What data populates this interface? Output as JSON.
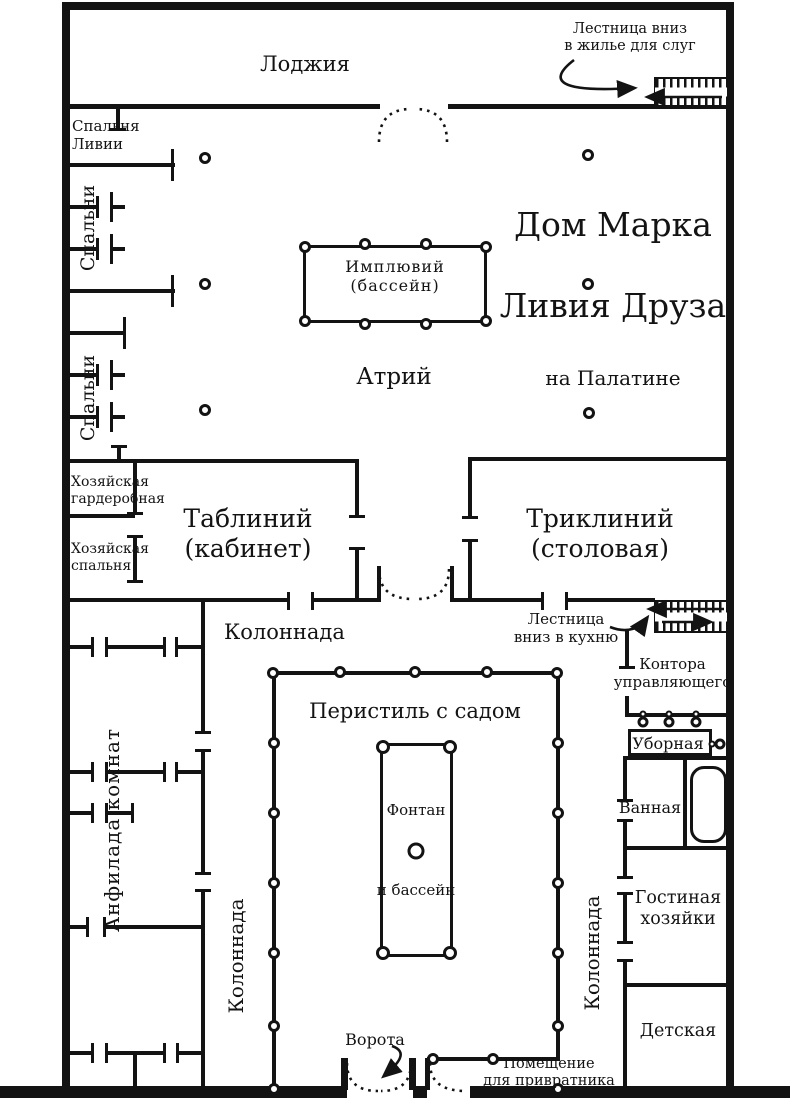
{
  "plan": {
    "title": {
      "line1": "Дом Марка",
      "line2": "Ливия Друза",
      "line3": "на Палатине"
    },
    "labels": {
      "loggia": "Лоджия",
      "stairs_servants": "Лестница вниз\nв жилье для слуг",
      "livia_bedroom": "Спальня\nЛивии",
      "bedrooms_a": "Спальни",
      "bedrooms_b": "Спальни",
      "impluvium": "Имплювий\n(бассейн)",
      "atrium": "Атрий",
      "wardrobe": "Хозяйская\nгардеробная",
      "master_bedroom": "Хозяйская\nспальня",
      "tablinum": "Таблиний\n(кабинет)",
      "triclinium": "Триклиний\n(столовая)",
      "stairs_kitchen": "Лестница\nвниз в кухню",
      "colonnade_top": "Колоннада",
      "office": "Контора\nуправляющего",
      "peristyle": "Перистиль с садом",
      "lavatory": "Уборная",
      "bathroom": "Ванная",
      "enfilade": "Анфилада комнат",
      "fountain_top": "Фонтан",
      "fountain_bottom": "и бассейн",
      "sitting_room": "Гостиная\nхозяйки",
      "colonnade_left": "Колоннада",
      "colonnade_right": "Колоннада",
      "nursery": "Детская",
      "gate": "Ворота",
      "porter": "Помещение\nдля привратника"
    },
    "colors": {
      "ink": "#131313",
      "paper": "#ffffff"
    }
  }
}
